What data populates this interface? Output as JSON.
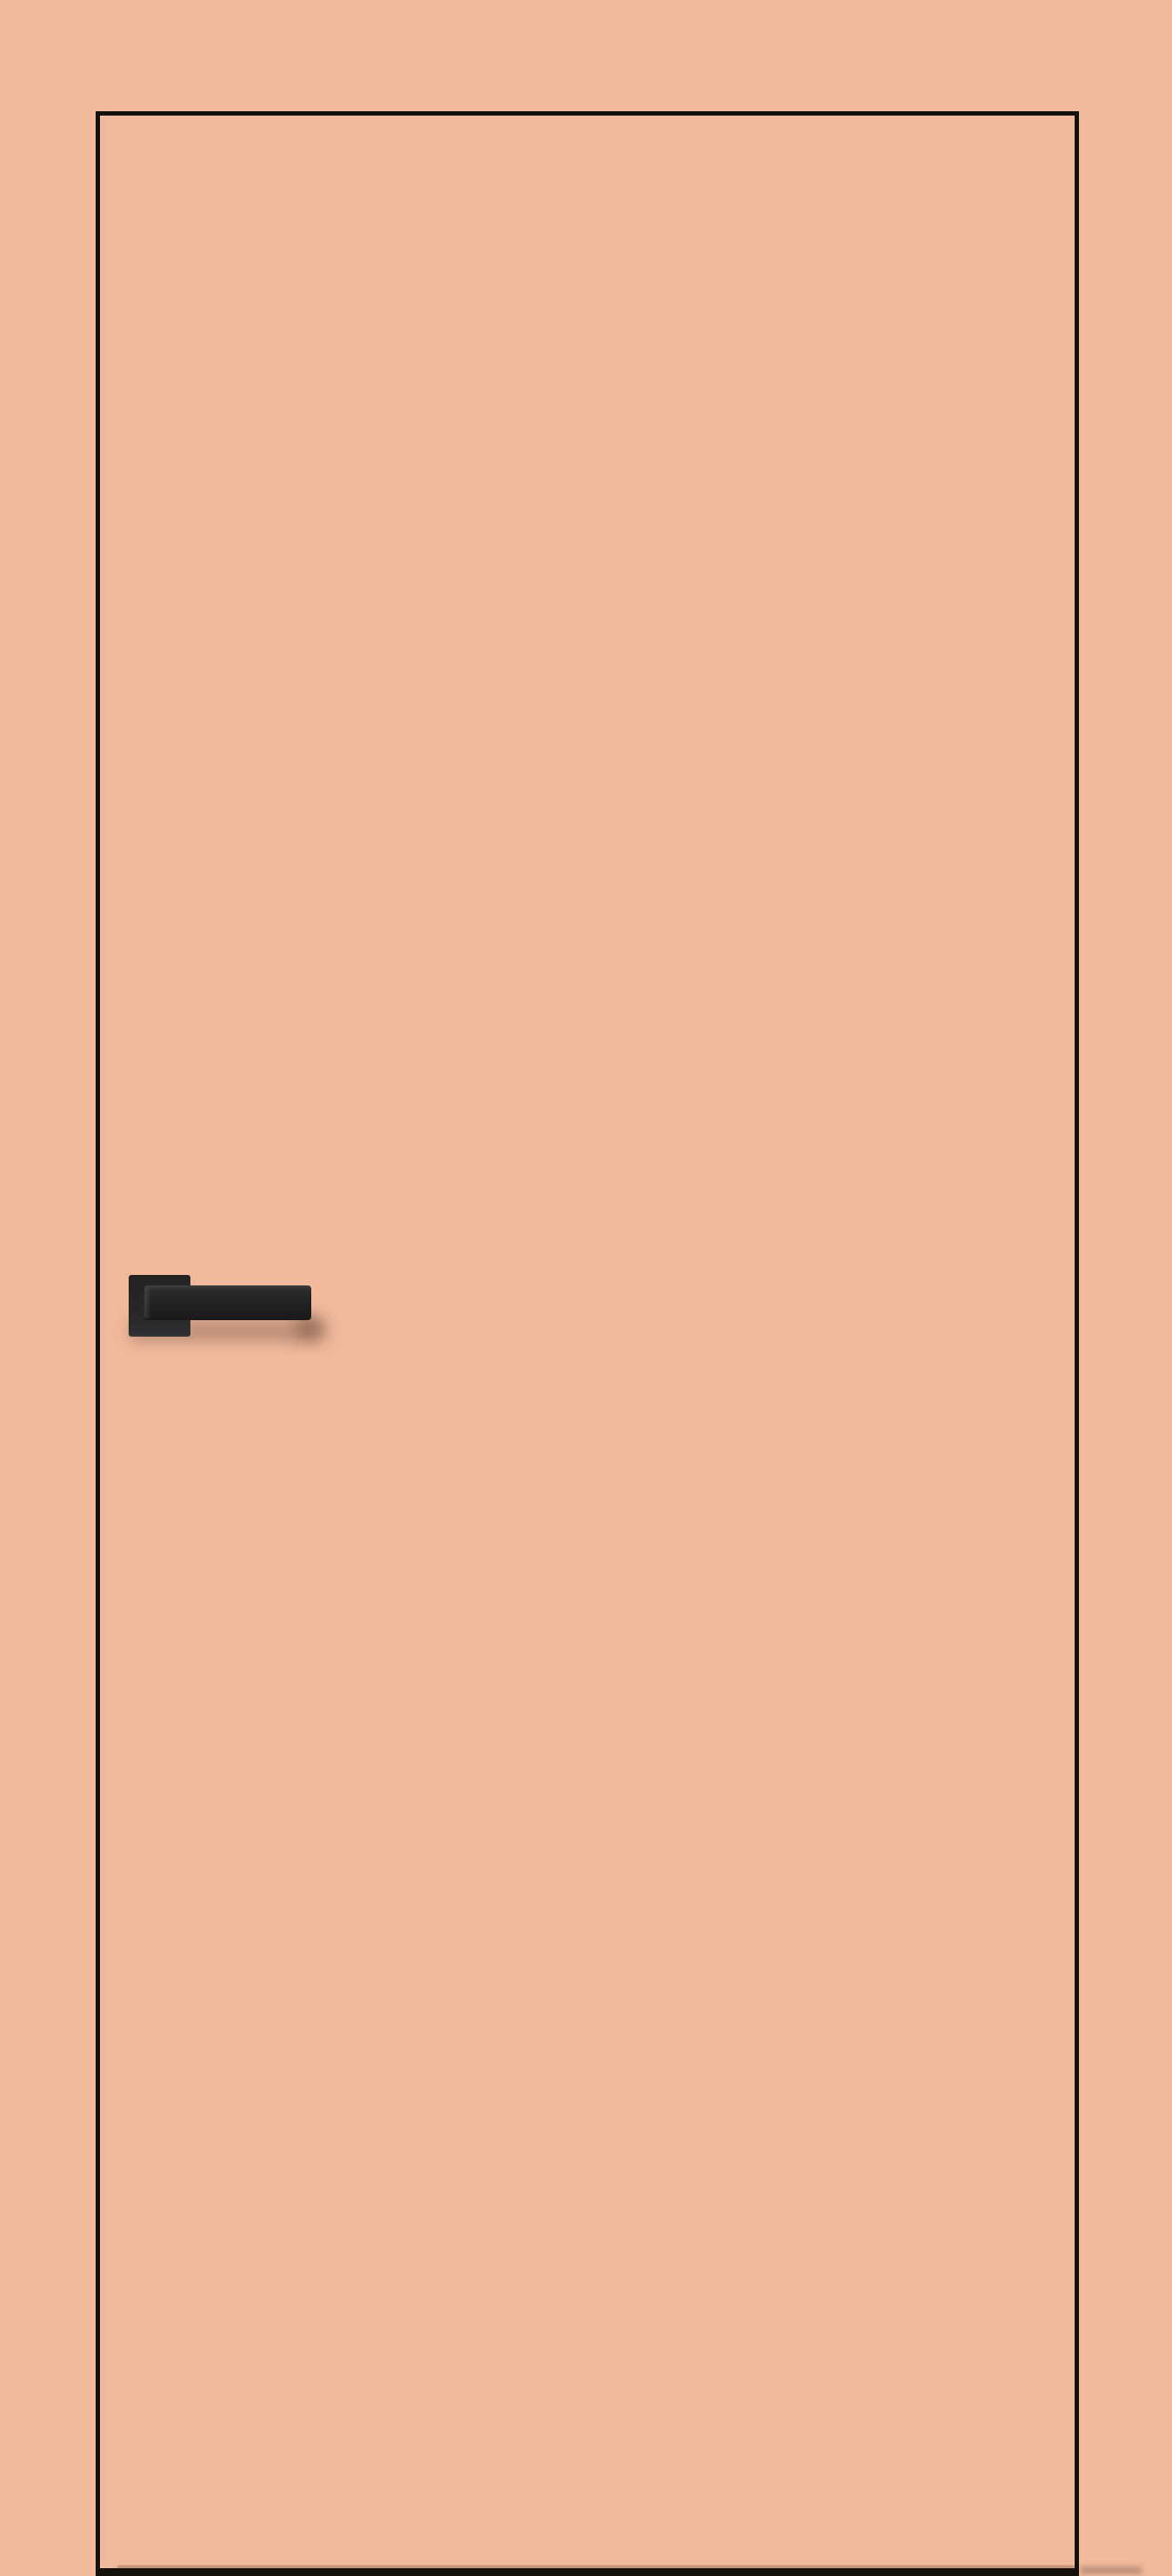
{
  "meta": {
    "type": "product-render",
    "subject": "flush interior door, peach finish with dark edge trim and black square-rosette lever handle"
  },
  "colors": {
    "background": "#f1ba9d",
    "door_fill": "#f1ba9d",
    "door_outline": "#14100c",
    "handle_body": "#232323",
    "handle_highlight": "#404040",
    "shadow_tint": "rgba(80,50,38,0.32)"
  },
  "objects": {
    "door": "door-leaf",
    "handle": "lever-handle",
    "rosette": "square-rosette",
    "shadow": "handle-cast-shadow"
  }
}
